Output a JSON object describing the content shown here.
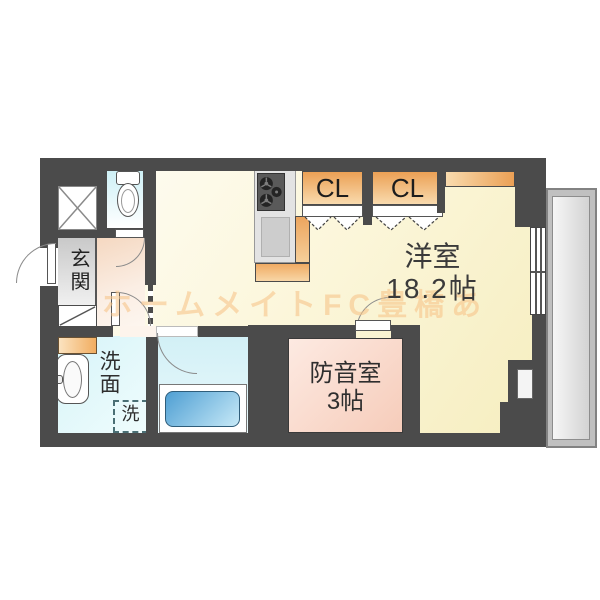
{
  "floorplan": {
    "watermark": "ホームメイトFC豊橋あ",
    "rooms": {
      "entrance": {
        "label": "玄関"
      },
      "western_room": {
        "label": "洋室",
        "size": "18.2帖"
      },
      "soundproof_room": {
        "label": "防音室",
        "size": "3帖"
      },
      "closet1": {
        "label": "CL"
      },
      "closet2": {
        "label": "CL"
      },
      "washroom": {
        "label": "洗面"
      },
      "washing_machine": {
        "label": "洗"
      }
    },
    "colors": {
      "wall": "#4b4b4b",
      "floor_cream": "#f8efc2",
      "closet_orange": "#eca159",
      "water_cyan": "#d5f2f7",
      "soundproof_pink": "#f7cfbd",
      "tub_blue": "#4f9fd3",
      "entrance_gray": "#d6d6d6",
      "balcony_gray": "#d3d3d3"
    }
  }
}
